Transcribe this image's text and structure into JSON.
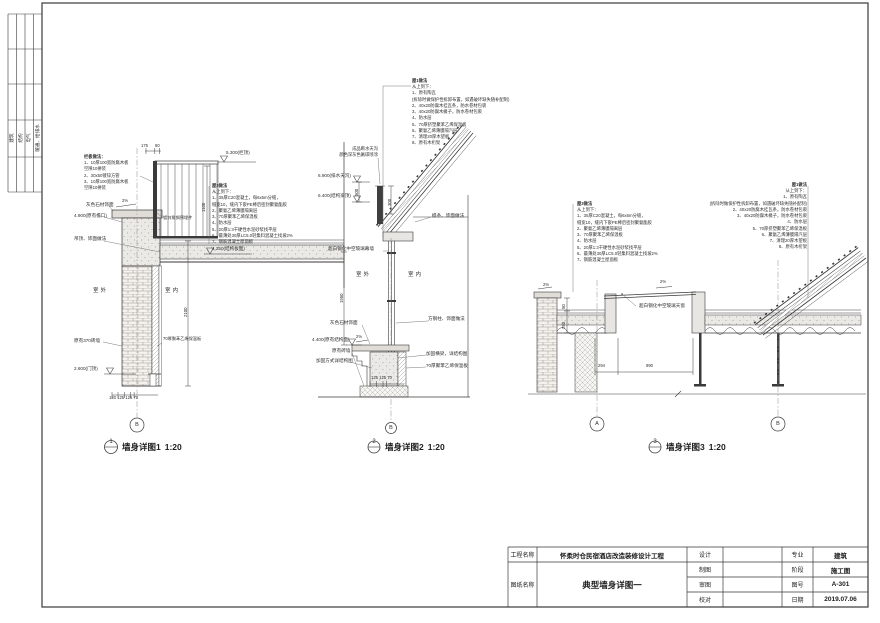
{
  "sign_strip": {
    "labels": [
      "建筑",
      "结构",
      "电气",
      "暖通、给排水"
    ]
  },
  "notes": {
    "roof3": {
      "title": "屋3做法",
      "dir": "从上到下：",
      "lines": [
        "1、35厚C20混凝土，每6x6m分缝，",
        "缝宽10，缝内下嵌PE棒后密封聚氨酯胶",
        "2、聚氨乙烯薄膜隔离层",
        "3、70厚聚苯乙烯保温板",
        "4、防水层",
        "5、20厚1:3干硬性水泥砂浆找平层",
        "6、最薄处30厚LC5.0轻集料混凝土找坡2%",
        "7、钢筋混凝土屋面板"
      ]
    },
    "roof1": {
      "title": "屋1做法",
      "dir": "从上到下：",
      "lines": [
        "1、原有陶瓦",
        "(拆除时做保护性拆卸布置，如遇破坏缺失随补配制)",
        "2、40x20防腐木挂瓦条，防水卷材包裹",
        "3、40x20防腐木椽子，防水卷材包裹",
        "4、防水层",
        "5、70厚挤塑聚苯乙烯保温板",
        "6、聚氨乙烯薄膜隔汽层",
        "7、清理20厚木望板",
        "8、原有木桁架"
      ]
    },
    "railing": {
      "title": "栏板做法：",
      "lines": [
        "1、10厚100宽防腐木板",
        "空隙10拼装",
        "2、30x50镀锌方管",
        "3、10厚100宽防腐木板",
        "空隙10拼装"
      ]
    }
  },
  "d1": {
    "labels": {
      "stone": "灰色石材饰面",
      "eave": "4.900(原有檐口)",
      "ceiling": "吊顶、饰面做法",
      "brick": "原有370砖墙",
      "insul": "70厚聚苯乙烯保温板",
      "embed": "镀锌角钢预埋件",
      "outdoor": "室外",
      "indoor": "室内"
    },
    "elev": {
      "top": "5.300(栏顶)",
      "slab": "4.250(结构板面)",
      "door": "2.600(门顶)"
    },
    "dims": {
      "a": "175",
      "b": "90",
      "h1": "1100",
      "h2": "2100",
      "bottom": "120 125 125 70",
      "slope": "2%"
    },
    "grid": "B",
    "num": "1",
    "title": "墙身详图1",
    "scale": "1:20"
  },
  "d2": {
    "labels": {
      "gutter1": "成品断水天沟",
      "gutter2": "颜色深灰色氟碳喷涂",
      "purlin": "檩条、饰面做法",
      "curtain": "超白钢化中空玻璃幕墙",
      "outdoor": "室外",
      "indoor": "室内",
      "stone": "灰色石材饰面",
      "existing": "原有砖墙",
      "reinforce": "加固方式详结构图",
      "column": "方钢柱、饰面做法",
      "beam": "加固横梁，详结构图",
      "insul": "70厚聚苯乙烯保温板"
    },
    "elev": {
      "gutter": "6.900(排水天沟)",
      "beam": "6.400(结构梁顶)",
      "sill": "4.400(原有结构面)"
    },
    "dims": {
      "v500": "500",
      "v300": "300",
      "v1950": "1950",
      "bottom": "125 125 70",
      "slope": "2%"
    },
    "grid": "B",
    "num": "2",
    "title": "墙身详图2",
    "scale": "1:20"
  },
  "d3": {
    "labels": {
      "skylight": "超白钢化中空玻璃天窗"
    },
    "dims": {
      "a": "294",
      "b": "990",
      "v1": "50",
      "v2": "250",
      "s1": "2%",
      "s2": "2%"
    },
    "grid_a": "A",
    "grid_b": "B",
    "num": "3",
    "title": "墙身详图3",
    "scale": "1:20"
  },
  "tb": {
    "project_label": "工程名称",
    "project": "怀柔时仓民宿酒店改造装修设计工程",
    "sheet_label": "图纸名称",
    "sheet": "典型墙身详图一",
    "design": "设计",
    "draft": "制图",
    "review": "审图",
    "proof": "校对",
    "major_label": "专业",
    "major": "建筑",
    "stage_label": "阶段",
    "stage": "施工图",
    "no_label": "图号",
    "no": "A-301",
    "date_label": "日期",
    "date": "2019.07.06"
  }
}
